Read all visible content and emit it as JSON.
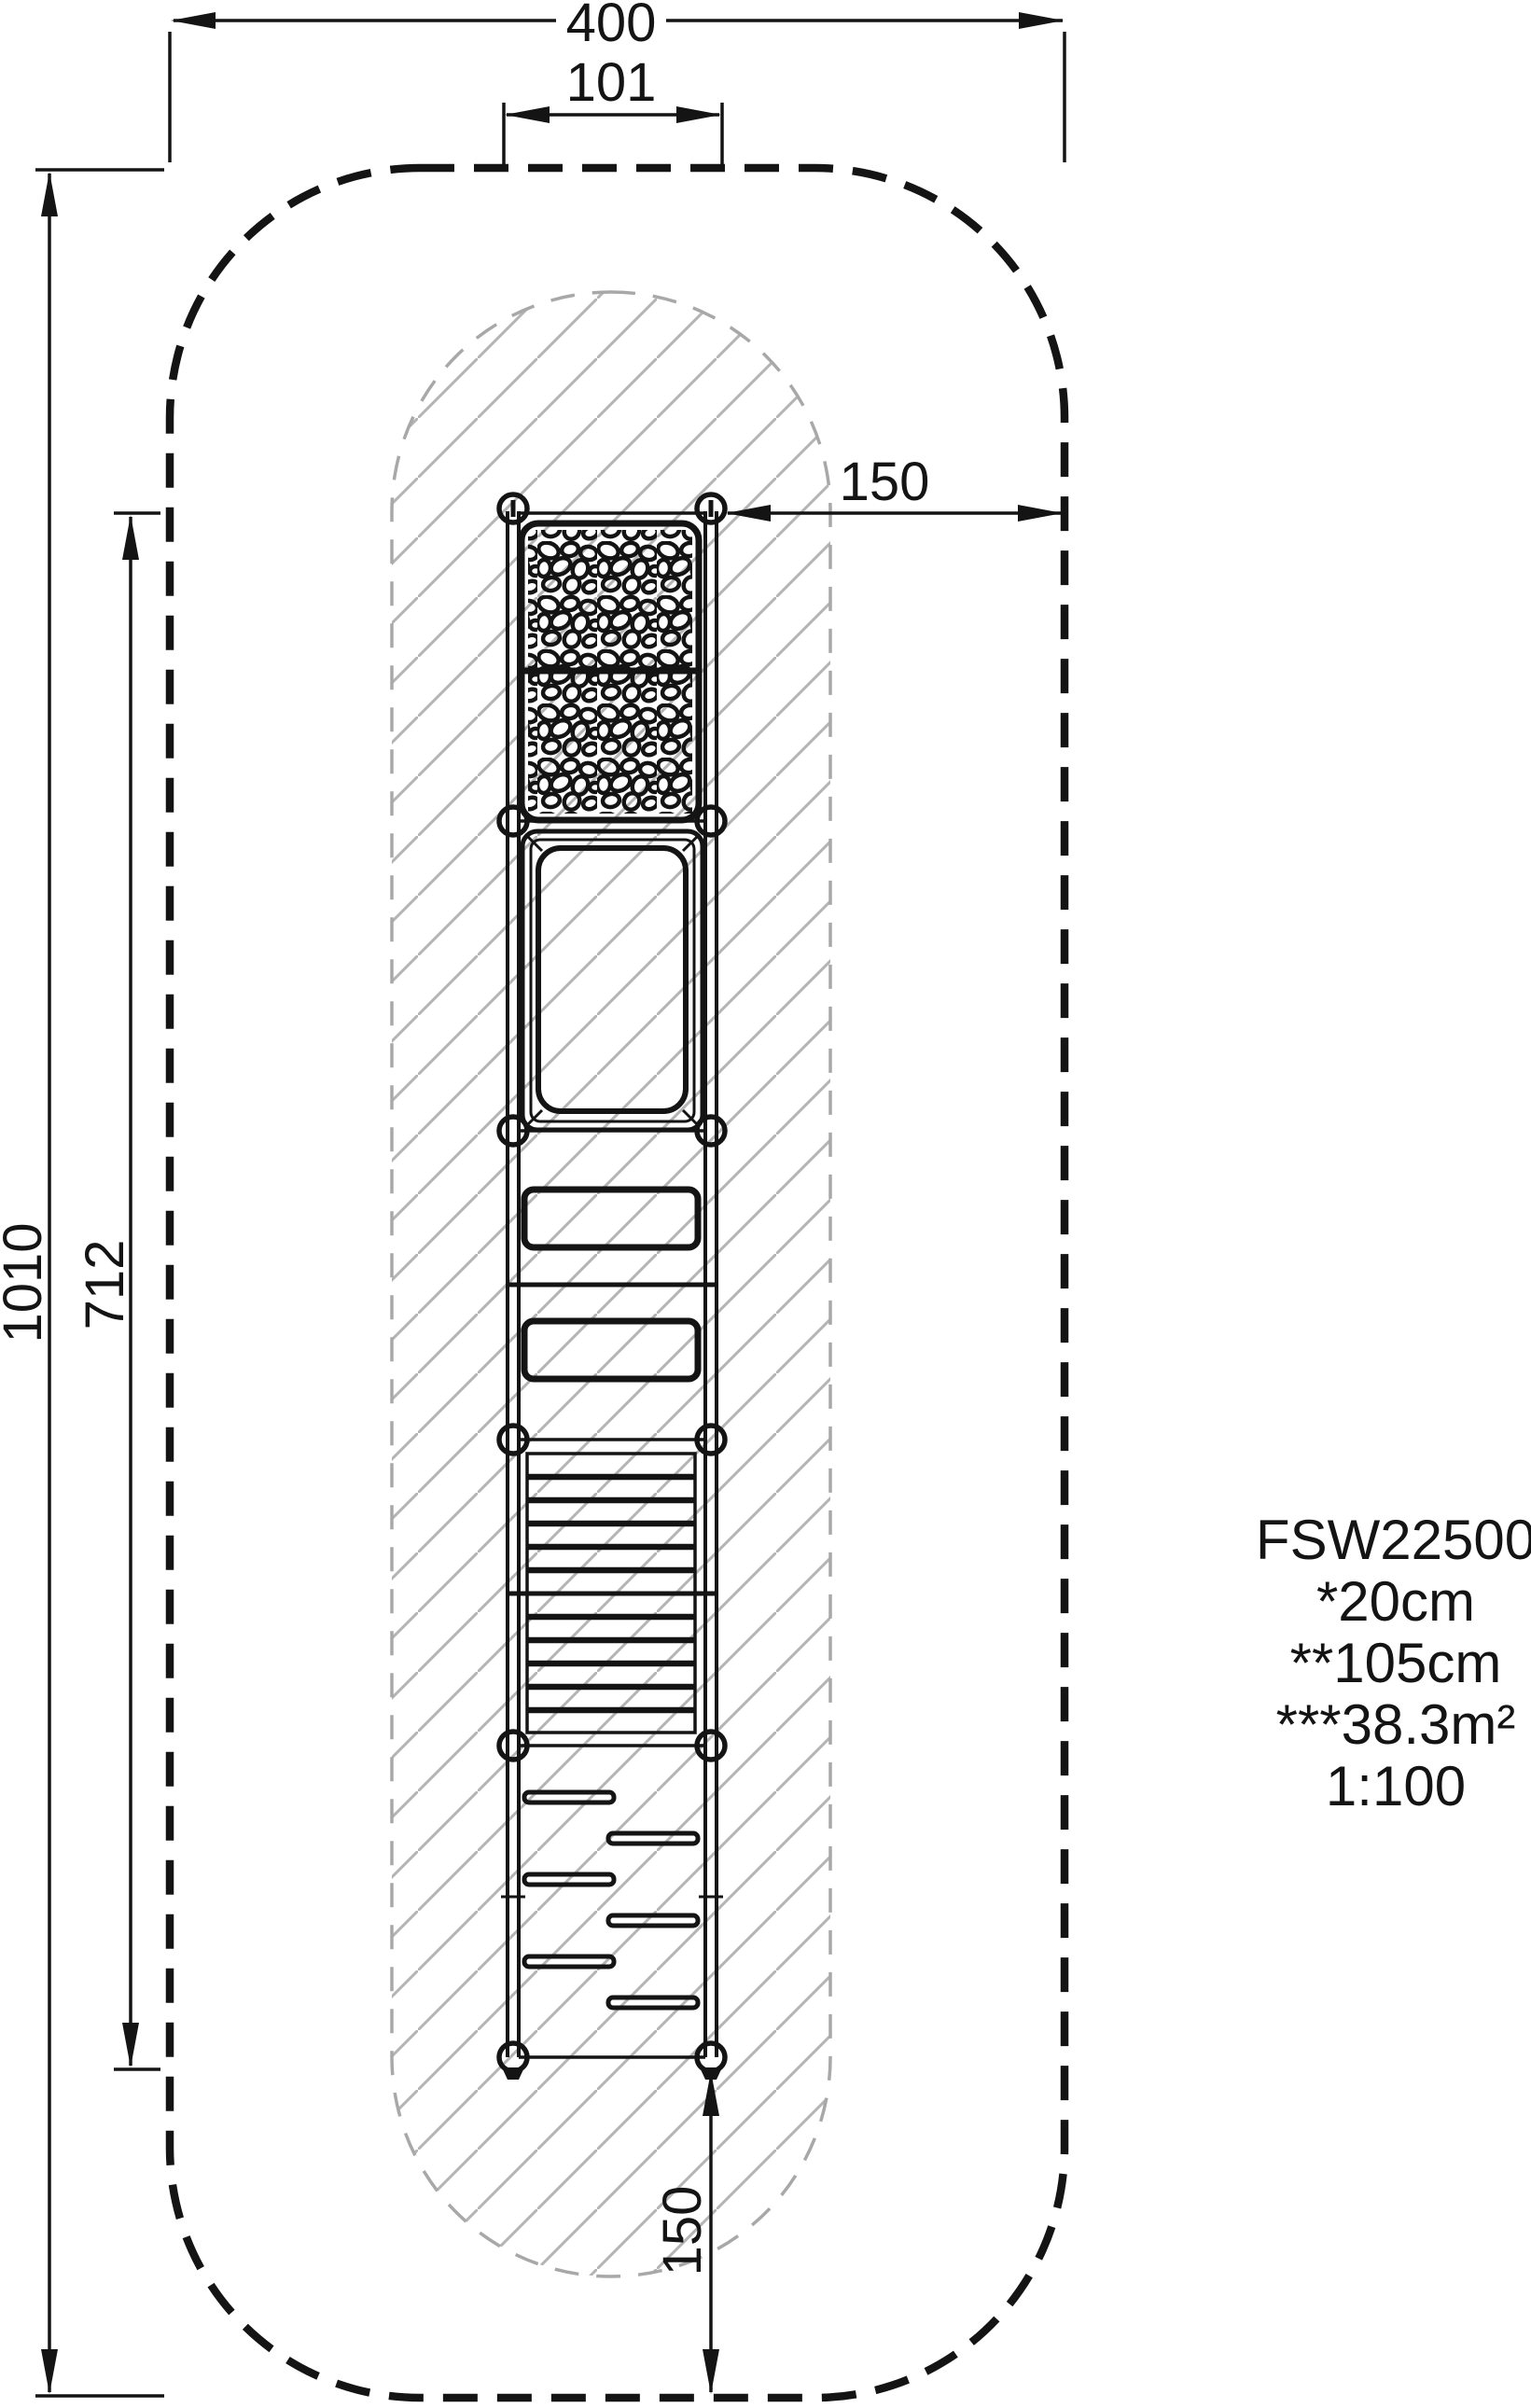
{
  "drawing": {
    "dims": {
      "top_overall": "400",
      "top_inner": "101",
      "right_clearance": "150",
      "left_overall": "1010",
      "left_inner": "712",
      "bottom_clearance": "150"
    },
    "info_block": {
      "model": "FSW22500",
      "note1": "*20cm",
      "note2": "**105cm",
      "note3": "***38.3m²",
      "scale": "1:100"
    },
    "colors": {
      "line": "#141414",
      "hatch": "#b4b4b4",
      "zone_dash": "#141414",
      "impact_dash": "#a8a8a8",
      "background": "#ffffff"
    }
  }
}
